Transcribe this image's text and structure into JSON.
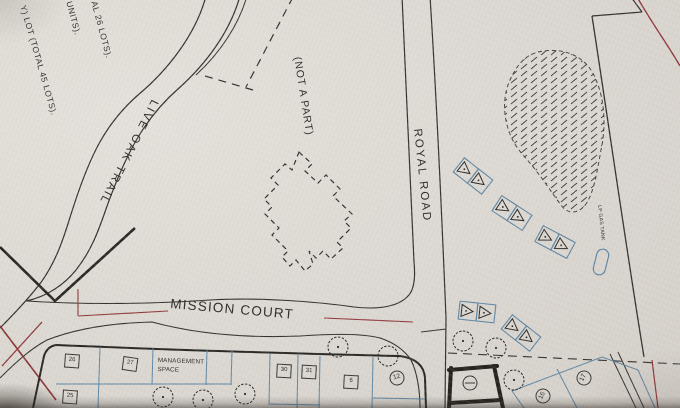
{
  "colors": {
    "paper": "#dcd8d2",
    "ink": "#2e2c29",
    "blue": "#5f87a6",
    "red": "#903a3b"
  },
  "labels": {
    "note_1": "AL 26 LOTS).",
    "note_2": "UNITS).",
    "note_3": "Y) LOT (TOTAL 45 LOTS).",
    "not_a_part": "(NOT A PART)",
    "live_oak_trail": "LIVE OAK TRAIL",
    "royal_road": "ROYAL ROAD",
    "mission_court": "MISSION COURT",
    "management_space_1": "MANAGEMENT",
    "management_space_2": "SPACE",
    "lp_gas_tank": "LP GAS TANK"
  },
  "symbols": {
    "trees": [
      {
        "x": 338,
        "y": 347
      },
      {
        "x": 388,
        "y": 356
      },
      {
        "x": 463,
        "y": 341
      },
      {
        "x": 496,
        "y": 348
      },
      {
        "x": 514,
        "y": 380
      },
      {
        "x": 245,
        "y": 394
      },
      {
        "x": 163,
        "y": 397
      },
      {
        "x": 203,
        "y": 400
      }
    ],
    "campsites": [
      {
        "x": 473,
        "y": 176,
        "rot": 38
      },
      {
        "x": 512,
        "y": 213,
        "rot": 33
      },
      {
        "x": 555,
        "y": 242,
        "rot": 28
      },
      {
        "x": 477,
        "y": 312,
        "rot": 6
      },
      {
        "x": 521,
        "y": 333,
        "rot": 38
      }
    ],
    "lot_boxes": [
      {
        "n": "26",
        "x": 72,
        "y": 361,
        "rot": 4
      },
      {
        "n": "27",
        "x": 130,
        "y": 364,
        "rot": 8
      },
      {
        "n": "25",
        "x": 70,
        "y": 397,
        "rot": 4
      },
      {
        "n": "30",
        "x": 284,
        "y": 371,
        "rot": 3
      },
      {
        "n": "31",
        "x": 309,
        "y": 372,
        "rot": 3
      },
      {
        "n": "6",
        "x": 351,
        "y": 382,
        "rot": 3
      }
    ],
    "circled_numbers": [
      {
        "n": "12",
        "x": 397,
        "y": 378,
        "rot": -15
      },
      {
        "n": "16",
        "x": 543,
        "y": 396,
        "rot": -65
      },
      {
        "n": "17",
        "x": 584,
        "y": 378,
        "rot": -65
      }
    ]
  }
}
